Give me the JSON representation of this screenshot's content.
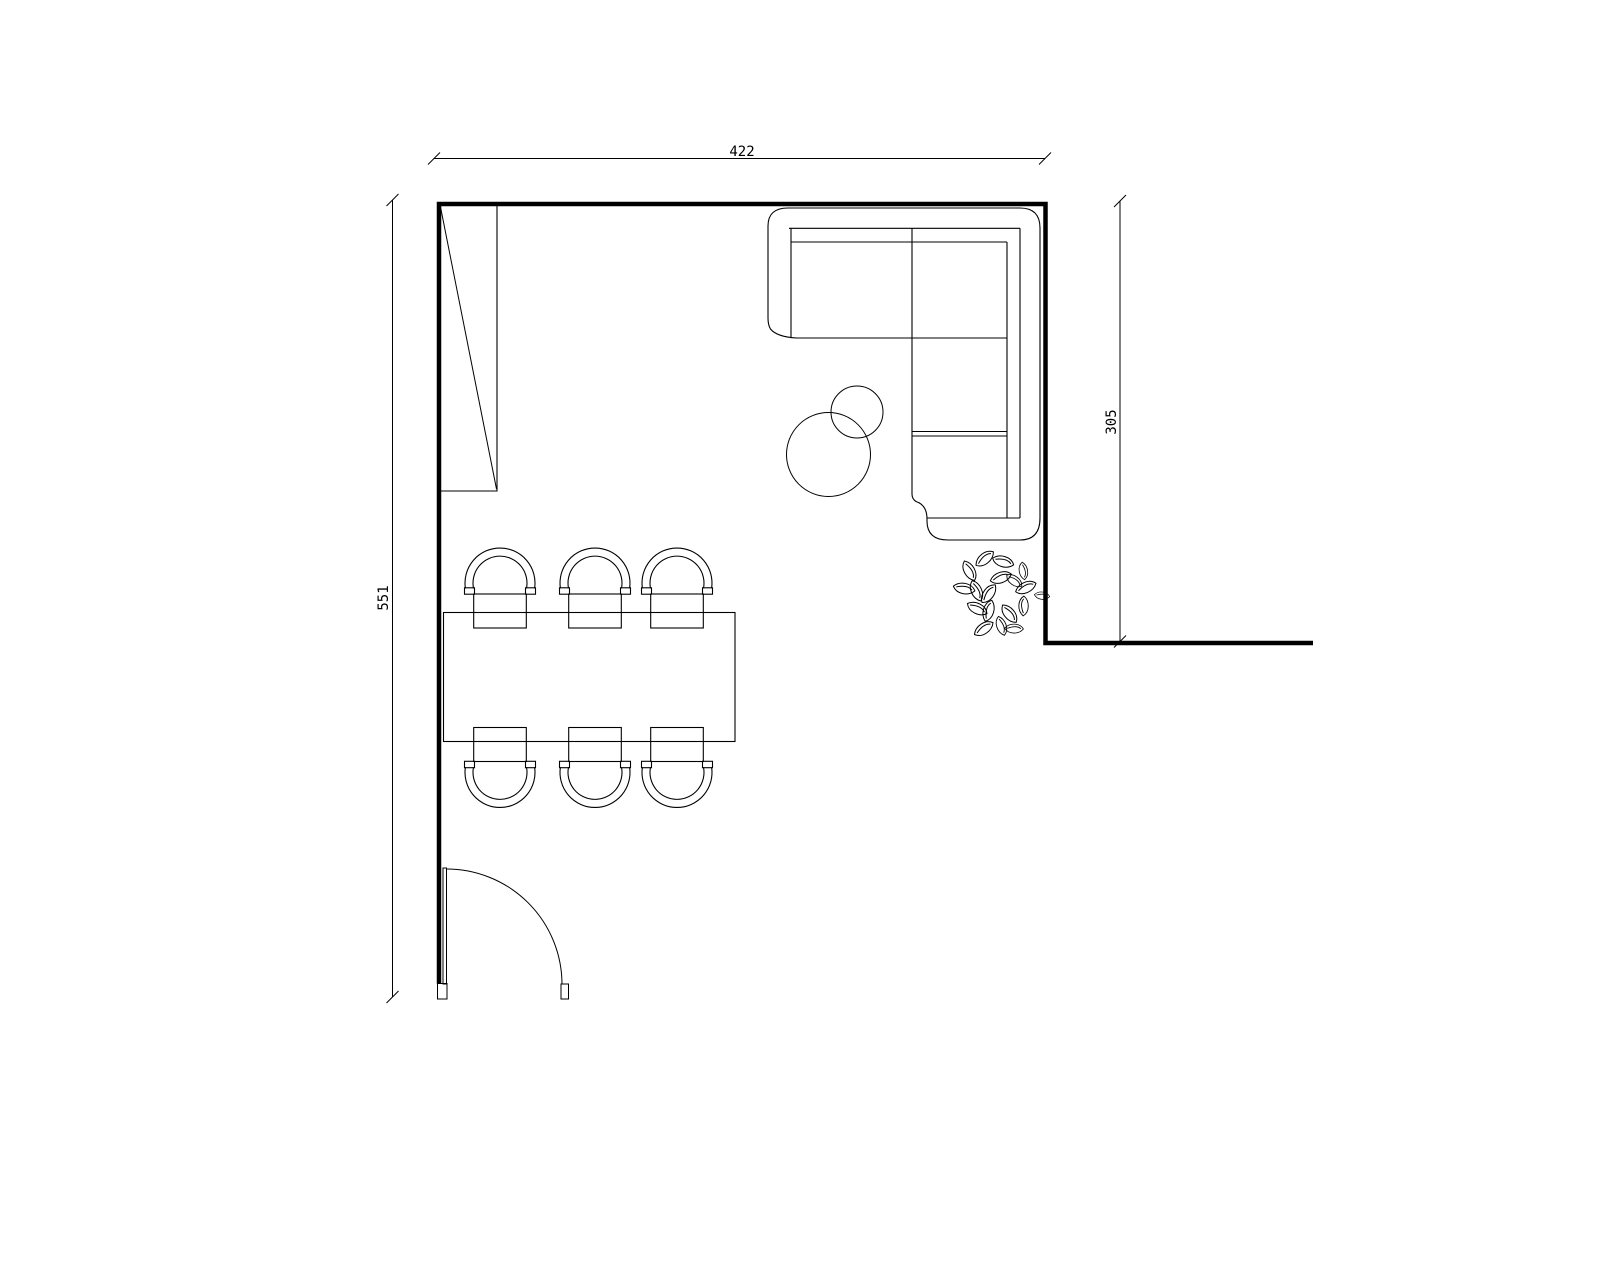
{
  "page": {
    "title": "Living / dining room floor plan",
    "background_color": "#ffffff",
    "line_color": "#000000"
  },
  "dimensions": {
    "top": {
      "label": "422",
      "orientation": "horizontal"
    },
    "left": {
      "label": "551",
      "orientation": "vertical"
    },
    "right": {
      "label": "305",
      "orientation": "vertical"
    }
  },
  "drawing": {
    "stroke_color": "#000000",
    "wall_color": "#000000",
    "symbols": [
      "sectional-sofa",
      "round-side-table-large",
      "round-side-table-small",
      "dining-table",
      "dining-chair",
      "potted-plant",
      "door-swing",
      "tall-cabinet"
    ],
    "dining_chair_count": "6"
  }
}
